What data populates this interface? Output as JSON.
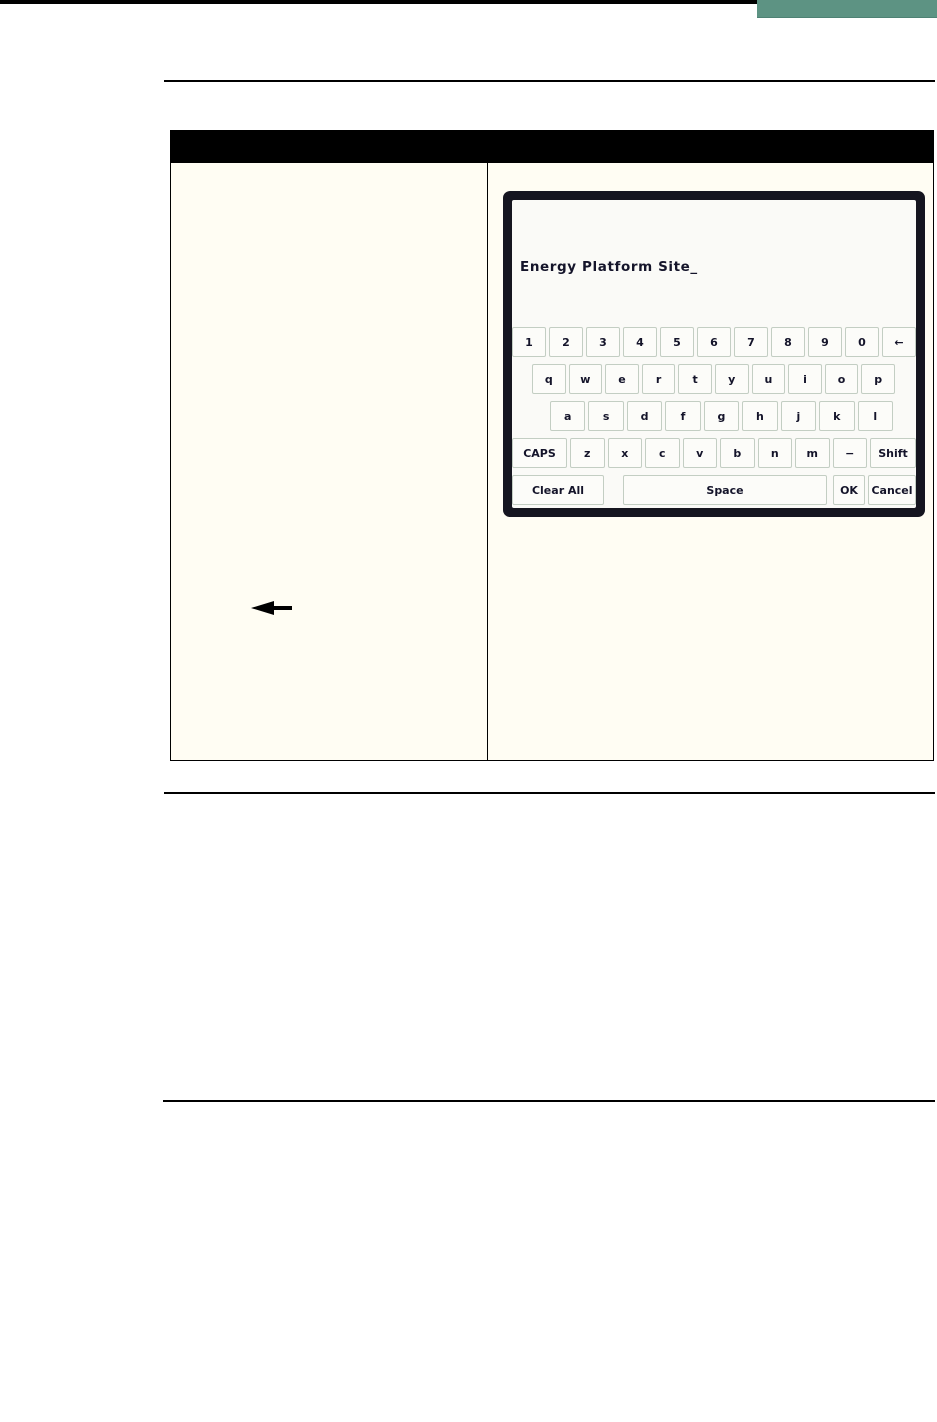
{
  "colors": {
    "accent_block": "#5d9383",
    "bars_and_borders": "#000000",
    "cell_background": "#fffdf3",
    "dialog_border": "#15151f",
    "dialog_background": "#fafaf7",
    "key_background": "#fcfcf9",
    "key_border": "#c3cec3",
    "key_text": "#14142a"
  },
  "callout": {
    "icon": "left-arrow"
  },
  "keyboard": {
    "input_text": "Energy Platform Site_",
    "rows": [
      [
        "1",
        "2",
        "3",
        "4",
        "5",
        "6",
        "7",
        "8",
        "9",
        "0",
        "←"
      ],
      [
        "q",
        "w",
        "e",
        "r",
        "t",
        "y",
        "u",
        "i",
        "o",
        "p"
      ],
      [
        "a",
        "s",
        "d",
        "f",
        "g",
        "h",
        "j",
        "k",
        "l"
      ],
      [
        "CAPS",
        "z",
        "x",
        "c",
        "v",
        "b",
        "n",
        "m",
        "−",
        "Shift"
      ],
      [
        "Clear All",
        "Space",
        "OK",
        "Cancel"
      ]
    ]
  }
}
